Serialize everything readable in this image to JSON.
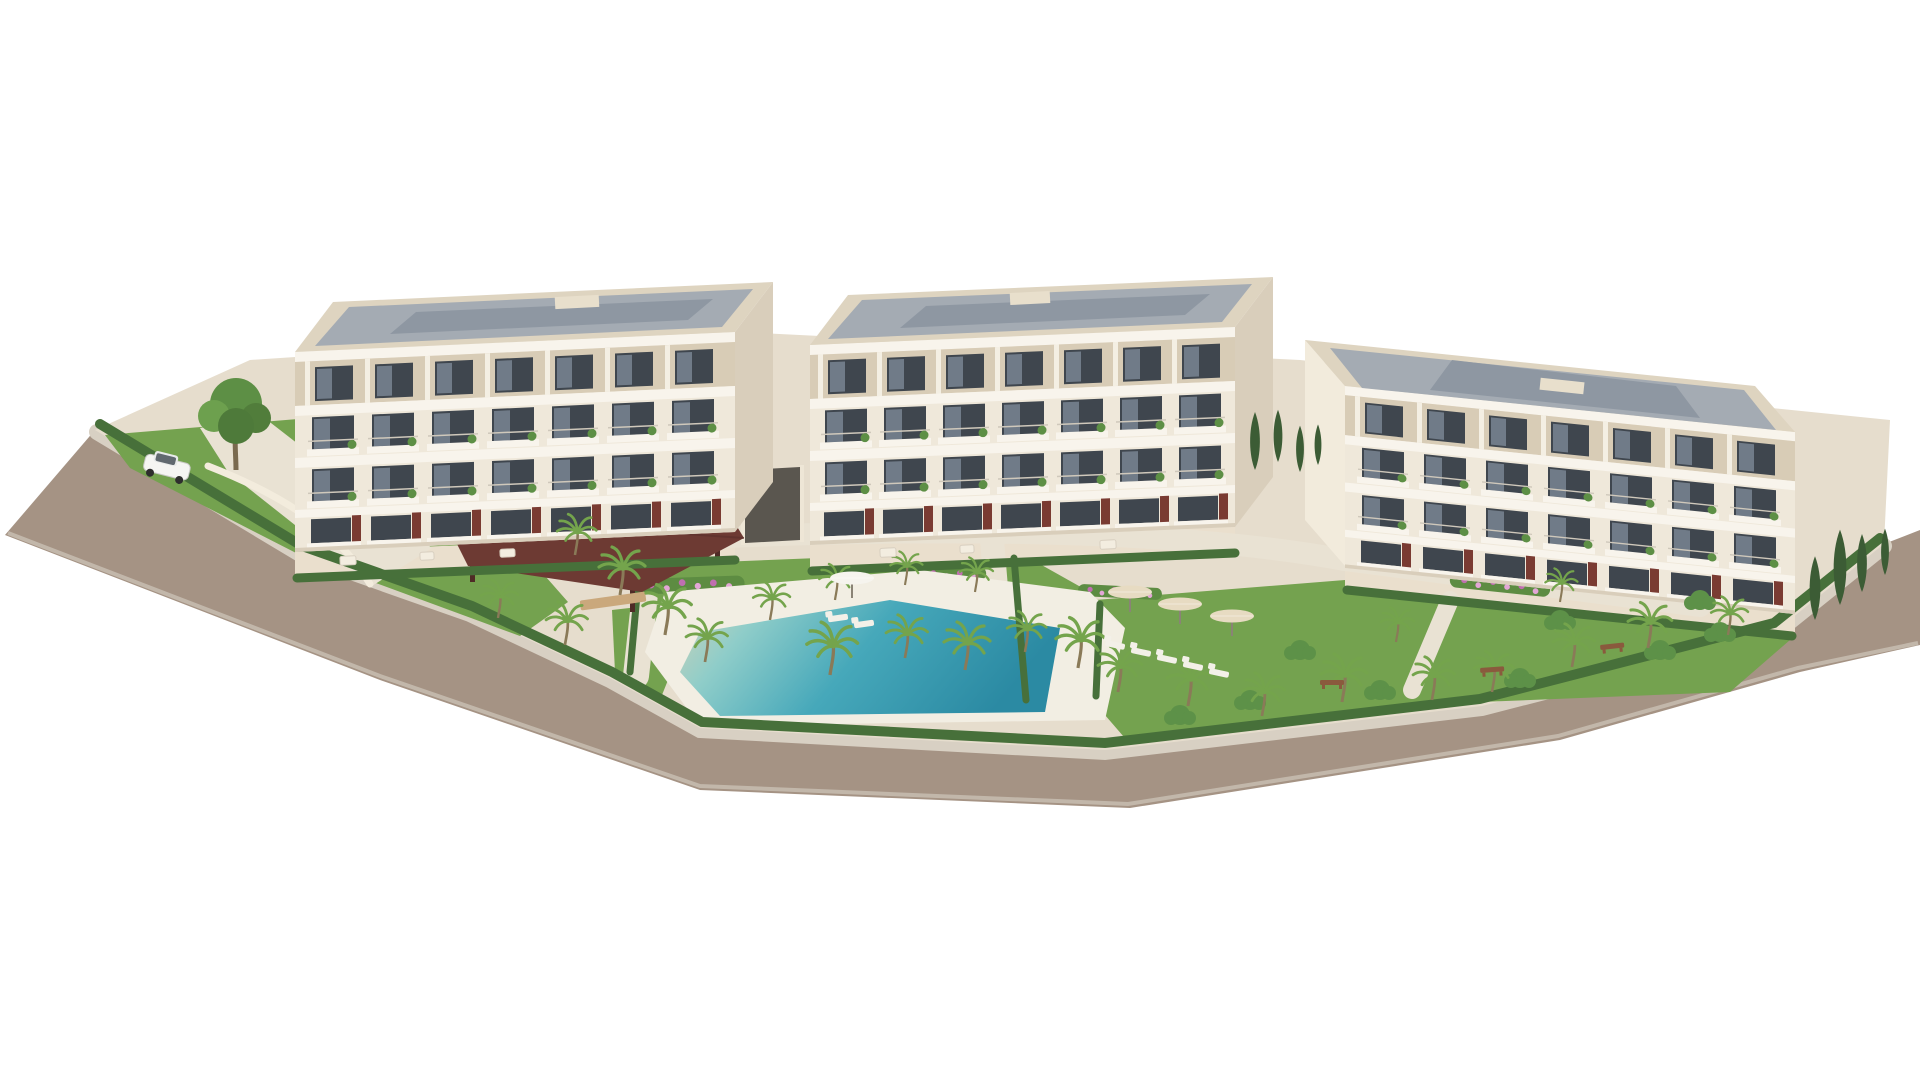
{
  "scene": {
    "title": "Aerial 3D architectural rendering of a residential complex",
    "description": "High-angle photorealistic visualization of three modern cream-colored apartment buildings with landscaped gardens, palm trees, a lagoon-style swimming pool with beach entry, a dark-wood gazebo, sun loungers with parasols, and a perimeter road, all on a plain white background",
    "camera": "high-angle aerial three-quarter view",
    "style": "photorealistic 3D render",
    "buildings": [
      {
        "name": "left-building",
        "floors": 4,
        "features": "penthouse roof terraces on slim columns, balconies with plants, rust-red terrace dividers, flat roof with glazed deck"
      },
      {
        "name": "middle-building",
        "floors": 4,
        "features": "penthouse roof terraces, balconies with planting, ground-floor garden terraces"
      },
      {
        "name": "right-building",
        "floors": 4,
        "features": "rotated orientation sloping to the right, roof terraces, balconies, cypress screen at its side"
      }
    ],
    "amenities": {
      "swimming_pools": 1,
      "gazebos": 1,
      "sun_umbrellas": 4,
      "sun_loungers": 7,
      "garden_benches": 3,
      "parked_cars": 1,
      "underground_parking_ramps": 1,
      "driveways": 1
    },
    "vegetation": {
      "palm_trees": 26,
      "cypress_trees": 8,
      "round_bushes": 9,
      "flower_beds": 6,
      "deciduous_trees": 1,
      "lawns": 4,
      "hedges": "continuous hedge along the road boundary and in front of each building"
    }
  },
  "colors": {
    "background": "#ffffff",
    "road": "#a59384",
    "road_edge": "#cfc6ba",
    "sidewalk": "#d8d0c3",
    "platform": "#e6ddcd",
    "path": "#e9e2d3",
    "lawn": "#74a24f",
    "lawn_shade": "#628f45",
    "hedge": "#47703a",
    "shrub": "#5d9148",
    "palm_frond": "#74a44c",
    "palm_trunk": "#8a7a58",
    "cypress": "#3c5c35",
    "flower_pink": "#c06fb0",
    "facade": "#efe8da",
    "facade_shade": "#d9cebb",
    "slab_white": "#f8f4ec",
    "penthouse_recess": "#d8ccb6",
    "parapet": "#ded4c0",
    "roof_deck": "#a4abb3",
    "roof_glazing": "#8e97a2",
    "window_glass": "#3f464e",
    "terrace_divider": "#7a3b32",
    "gazebo_roof": "#6d3a33",
    "pool_water": "#3a9cb2",
    "pool_beach_entry": "#cfd2b8",
    "pool_deck": "#f2eee3",
    "umbrella_beige": "#e7dbc2",
    "furniture_white": "#f3f0e8",
    "car_white": "#f5f5f3",
    "ramp_dark": "#5a564f"
  }
}
